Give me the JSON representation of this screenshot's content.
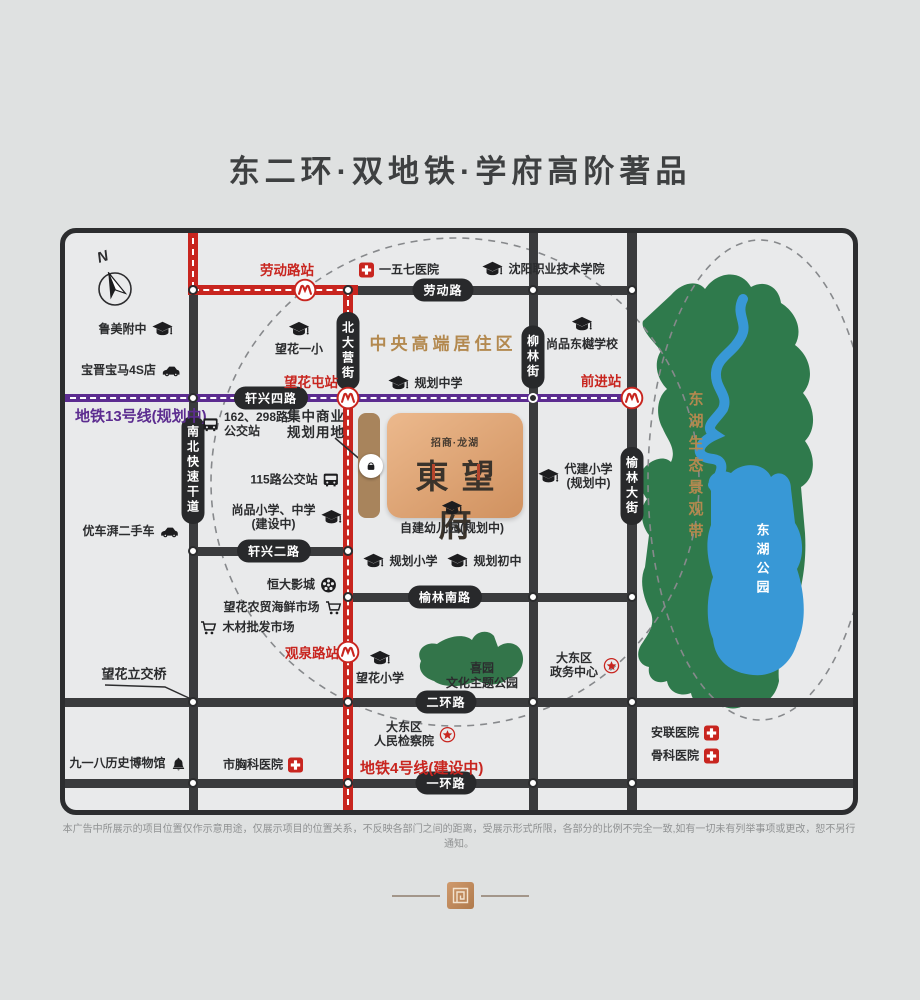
{
  "title": "东二环·双地铁·学府高阶著品",
  "map": {
    "compass_label": "N",
    "area_label": "中央高端居住区",
    "project": {
      "brand": "招商·龙湖",
      "name": "東望府"
    },
    "bridge_label": "望花立交桥",
    "metro_labels": {
      "line13": "地铁13号线(规划中)",
      "line4": "地铁4号线(建设中)"
    },
    "stations": {
      "laodonglu": "劳动路站",
      "wanghuatun": "望花屯站",
      "qianjin": "前进站",
      "guanquanlu": "观泉路站"
    },
    "roads": {
      "laodong": "劳动路",
      "xuanxing4": "轩兴四路",
      "xuanxing2": "轩兴二路",
      "yulinnan": "榆林南路",
      "erhuan": "二环路",
      "yihuan": "一环路",
      "beidaying": "北大营街",
      "liulin": "柳林街",
      "yulindajie": "榆林大街",
      "nanbei": "南北快速干道"
    },
    "parks": {
      "belt": "东湖生态景观带",
      "lake": "东湖公园",
      "xiyuan": [
        "喜园",
        "文化主题公园"
      ]
    },
    "pois": [
      {
        "t": "cap",
        "icon": "right",
        "x": 71,
        "y": 97,
        "lines": [
          "鲁美附中"
        ]
      },
      {
        "t": "car",
        "icon": "right",
        "x": 66,
        "y": 138,
        "lines": [
          "宝晋宝马4S店"
        ]
      },
      {
        "t": "cap",
        "icon": "top",
        "x": 234,
        "y": 105,
        "lines": [
          "望花一小"
        ]
      },
      {
        "t": "cross",
        "icon": "left",
        "x": 334,
        "y": 37,
        "lines": [
          "一五七医院"
        ]
      },
      {
        "t": "cap",
        "icon": "left",
        "x": 478,
        "y": 37,
        "lines": [
          "沈阳职业技术学院"
        ]
      },
      {
        "t": "cap",
        "icon": "top",
        "x": 517,
        "y": 100,
        "lines": [
          "尚品东樾学校"
        ]
      },
      {
        "t": "cap",
        "icon": "left",
        "x": 360,
        "y": 151,
        "lines": [
          "规划中学"
        ]
      },
      {
        "t": "bus",
        "icon": "left",
        "x": 180,
        "y": 192,
        "lines": [
          "162、298路",
          "公交站"
        ],
        "align": "left"
      },
      {
        "t": "label",
        "icon": "none",
        "x": 251,
        "y": 192,
        "lines": [
          "集中商业",
          "规划用地"
        ]
      },
      {
        "t": "bus",
        "icon": "right",
        "x": 230,
        "y": 247,
        "lines": [
          "115路公交站"
        ]
      },
      {
        "t": "cap",
        "icon": "right",
        "x": 222,
        "y": 285,
        "lines": [
          "尚品小学、中学",
          "(建设中)"
        ]
      },
      {
        "t": "cap",
        "icon": "left",
        "x": 510,
        "y": 244,
        "lines": [
          "代建小学",
          "(规划中)"
        ]
      },
      {
        "t": "cap",
        "icon": "top",
        "x": 387,
        "y": 284,
        "lines": [
          "自建幼儿园(规划中)"
        ]
      },
      {
        "t": "car",
        "icon": "right",
        "x": 66,
        "y": 299,
        "lines": [
          "优车湃二手车"
        ]
      },
      {
        "t": "film",
        "icon": "right",
        "x": 237,
        "y": 352,
        "lines": [
          "恒大影城"
        ]
      },
      {
        "t": "cart",
        "icon": "right",
        "x": 218,
        "y": 375,
        "lines": [
          "望花农贸海鲜市场"
        ]
      },
      {
        "t": "cart",
        "icon": "left",
        "x": 182,
        "y": 395,
        "lines": [
          "木材批发市场"
        ]
      },
      {
        "t": "cap",
        "icon": "left",
        "x": 335,
        "y": 329,
        "lines": [
          "规划小学"
        ]
      },
      {
        "t": "cap",
        "icon": "left",
        "x": 419,
        "y": 329,
        "lines": [
          "规划初中"
        ]
      },
      {
        "t": "cap",
        "icon": "top",
        "x": 315,
        "y": 434,
        "lines": [
          "望花小学"
        ]
      },
      {
        "t": "star",
        "icon": "right",
        "x": 520,
        "y": 433,
        "lines": [
          "大东区",
          "政务中心"
        ]
      },
      {
        "t": "star",
        "icon": "right",
        "x": 350,
        "y": 502,
        "lines": [
          "大东区",
          "人民检察院"
        ]
      },
      {
        "t": "bell",
        "icon": "right",
        "x": 63,
        "y": 531,
        "lines": [
          "九一八历史博物馆"
        ]
      },
      {
        "t": "cross",
        "icon": "right",
        "x": 198,
        "y": 532,
        "lines": [
          "市胸科医院"
        ]
      },
      {
        "t": "cross",
        "icon": "right",
        "x": 620,
        "y": 500,
        "lines": [
          "安联医院"
        ]
      },
      {
        "t": "cross",
        "icon": "right",
        "x": 620,
        "y": 523,
        "lines": [
          "骨科医院"
        ]
      }
    ]
  },
  "disclaimer": "本广告中所展示的项目位置仅作示意用途，仅展示项目的位置关系，不反映各部门之间的距离，受展示形式所限，各部分的比例不完全一致,如有一切未有列举事项或更改，恕不另行通知。",
  "colors": {
    "accent_red": "#c8251f",
    "metro_purple": "#5c2c90",
    "road_dark": "#3a3b3d",
    "gold": "#b3894f",
    "copper": "#d99e6f",
    "park_green": "#2f7a4c",
    "lake_blue": "#3898d6"
  }
}
